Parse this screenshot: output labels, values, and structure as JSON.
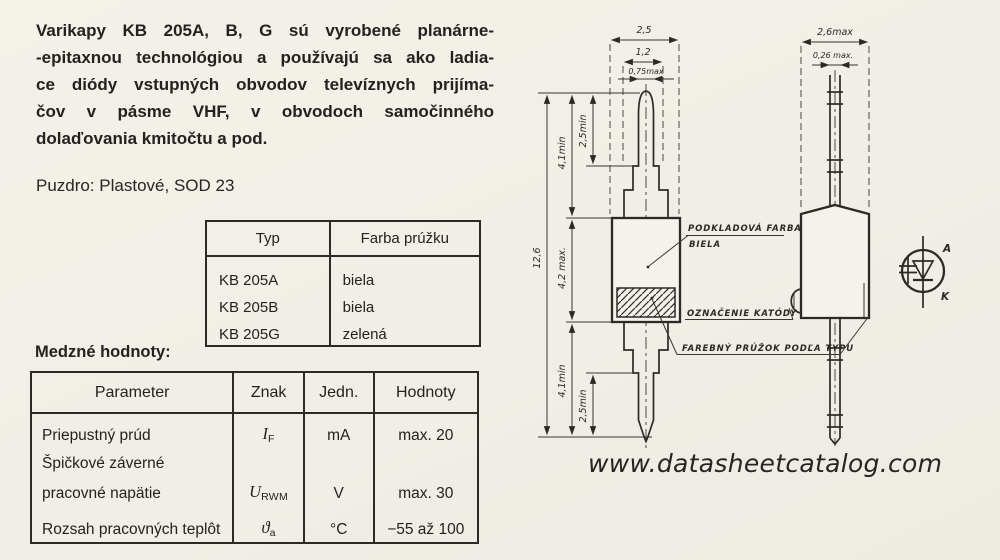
{
  "intro": {
    "lines": [
      "Varikapy KB 205A, B, G sú vyrobené planárne-",
      "-epitaxnou technológiou a používajú sa ako ladia-",
      "ce diódy vstupných obvodov televíznych prijíma-",
      "čov v pásme VHF, v obvodoch samočinného",
      "dolaďovania kmitočtu a pod."
    ]
  },
  "package_line": "Puzdro: Plastové, SOD 23",
  "type_table": {
    "col_typ": "Typ",
    "col_farba": "Farba prúžku",
    "rows": [
      {
        "typ": "KB 205A",
        "farba": "biela"
      },
      {
        "typ": "KB 205B",
        "farba": "biela"
      },
      {
        "typ": "KB 205G",
        "farba": "zelená"
      }
    ]
  },
  "limits": {
    "heading": "Medzné hodnoty:",
    "col_parameter": "Parameter",
    "col_znak": "Znak",
    "col_jedn": "Jedn.",
    "col_hodnoty": "Hodnoty",
    "row1": {
      "parameter": "Priepustný prúd",
      "sym": "I",
      "sub": "F",
      "unit": "mA",
      "value": "max. 20"
    },
    "row2": {
      "parameter_line1": "Špičkové záverné",
      "parameter_line2": "pracovné napätie",
      "sym": "U",
      "sub": "RWM",
      "unit": "V",
      "value": "max. 30"
    },
    "row3": {
      "parameter": "Rozsah pracovných teplôt",
      "sym": "ϑ",
      "sub": "a",
      "unit": "°C",
      "value": "−55 až 100"
    }
  },
  "drawing": {
    "front": {
      "dim_25": "2,5",
      "dim_12": "1,2",
      "dim_075": "0,75max",
      "dim_126": "12,6",
      "dim_41_top": "4,1min",
      "dim_42": "4,2 max.",
      "dim_41_bot": "4,1min",
      "dim_25min_top": "2,5min",
      "dim_25min_bot": "2,5min"
    },
    "side": {
      "dim_26": "2,6max",
      "dim_026": "0,26 max."
    },
    "labels": {
      "base_line1": "PODKLADOVÁ FARBA",
      "base_line2": "BIELA",
      "cathode": "OZNAČENIE KATÓDY",
      "stripe": "FAREBNÝ PRÚŽOK PODĽA TYPU"
    },
    "symbol": {
      "anode_label": "A",
      "cathode_label": "K"
    }
  },
  "footer": {
    "website": "www.datasheetcatalog.com"
  }
}
